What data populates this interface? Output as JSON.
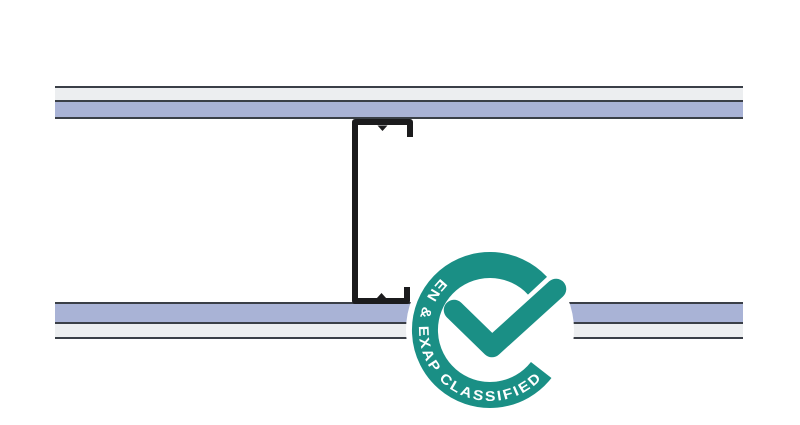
{
  "badge": {
    "label": "EN & EXAP CLASSIFIED"
  },
  "colors": {
    "background": "#FFFFFF",
    "board_face": "#ECEEF0",
    "board_core": "#A9B3D6",
    "outline": "#3A3F47",
    "stud": "#1B1B1D",
    "badge_teal": "#1A8F85",
    "badge_text": "#FFFFFF"
  }
}
